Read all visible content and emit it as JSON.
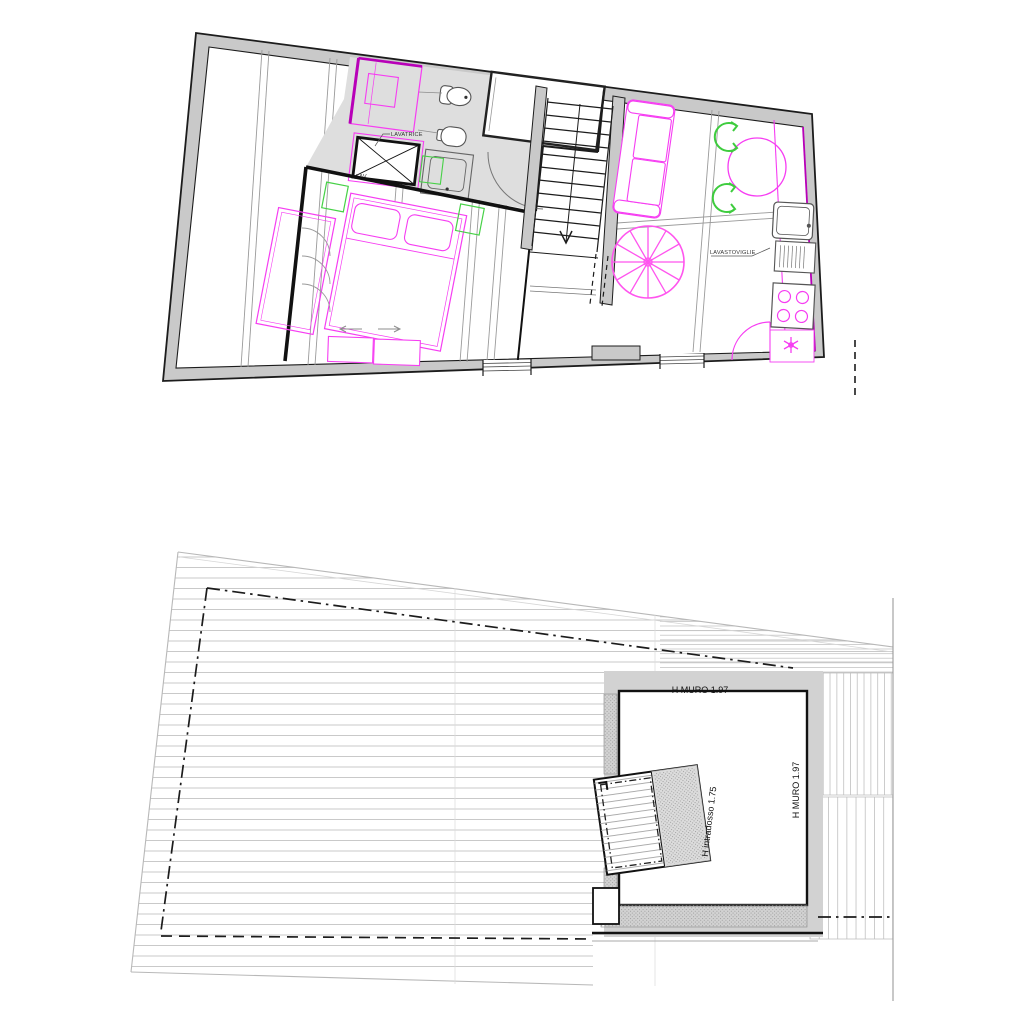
{
  "drawing": {
    "type": "architectural-plan-sheet",
    "background": "#ffffff"
  },
  "colors": {
    "wall_gray": "#c9c9c9",
    "floor_gray": "#dedede",
    "line_black": "#1c1c1c",
    "furniture_magenta": "#f63df2",
    "deep_magenta": "#b800b8",
    "fixture_green": "#47d147",
    "chair_green": "#3ecc3e",
    "joist_gray": "#9a9a9a",
    "hatch_gray": "#c9c9c9",
    "stipple_gray": "#9f9f9f"
  },
  "upper_plan": {
    "name": "floor-plan",
    "labels": {
      "lavatrice": "LAVATRICE",
      "lav": "LAV.",
      "lavastoviglie": "LAVASTOVIGLIE"
    }
  },
  "lower_plan": {
    "name": "roof-plan",
    "labels": {
      "h_muro_top": "H MURO 1.97",
      "h_muro_right": "H MURO 1.97",
      "h_intradosso": "H intradosso 1.75"
    }
  }
}
